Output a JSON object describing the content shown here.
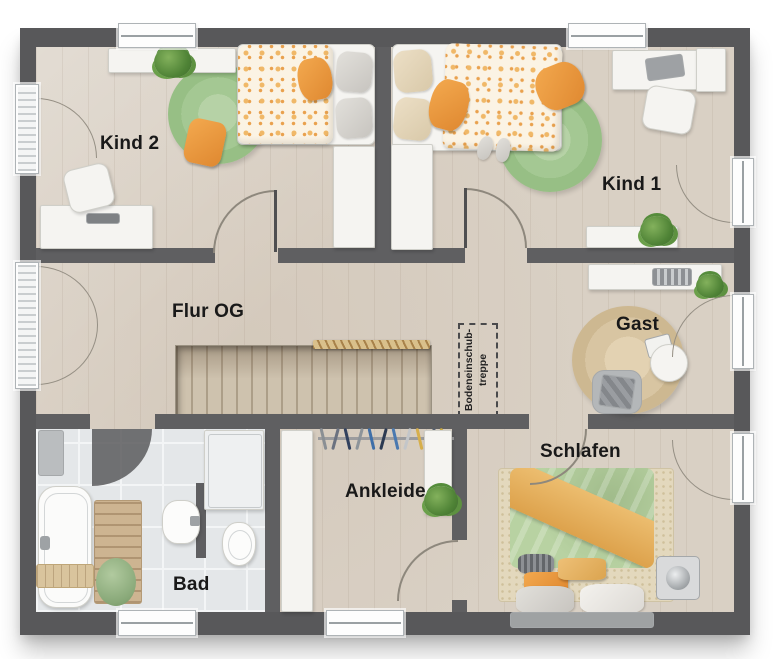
{
  "rooms": {
    "kind2": "Kind 2",
    "kind1": "Kind 1",
    "flur": "Flur OG",
    "gast": "Gast",
    "schlafen": "Schlafen",
    "ankleide": "Ankleide",
    "bad": "Bad"
  },
  "annotations": {
    "attic_ladder_line1": "Bodeneinschub-",
    "attic_ladder_line2": "treppe"
  },
  "colors": {
    "wall": "#58585a",
    "floor_wood": "#d9d0c4",
    "floor_tile": "#e4e7e9",
    "rug_green": "#a4c893",
    "rug_jute": "#d8c5a2",
    "accent_orange": "#ee9a43",
    "bed_green": "#b8d2a2"
  }
}
